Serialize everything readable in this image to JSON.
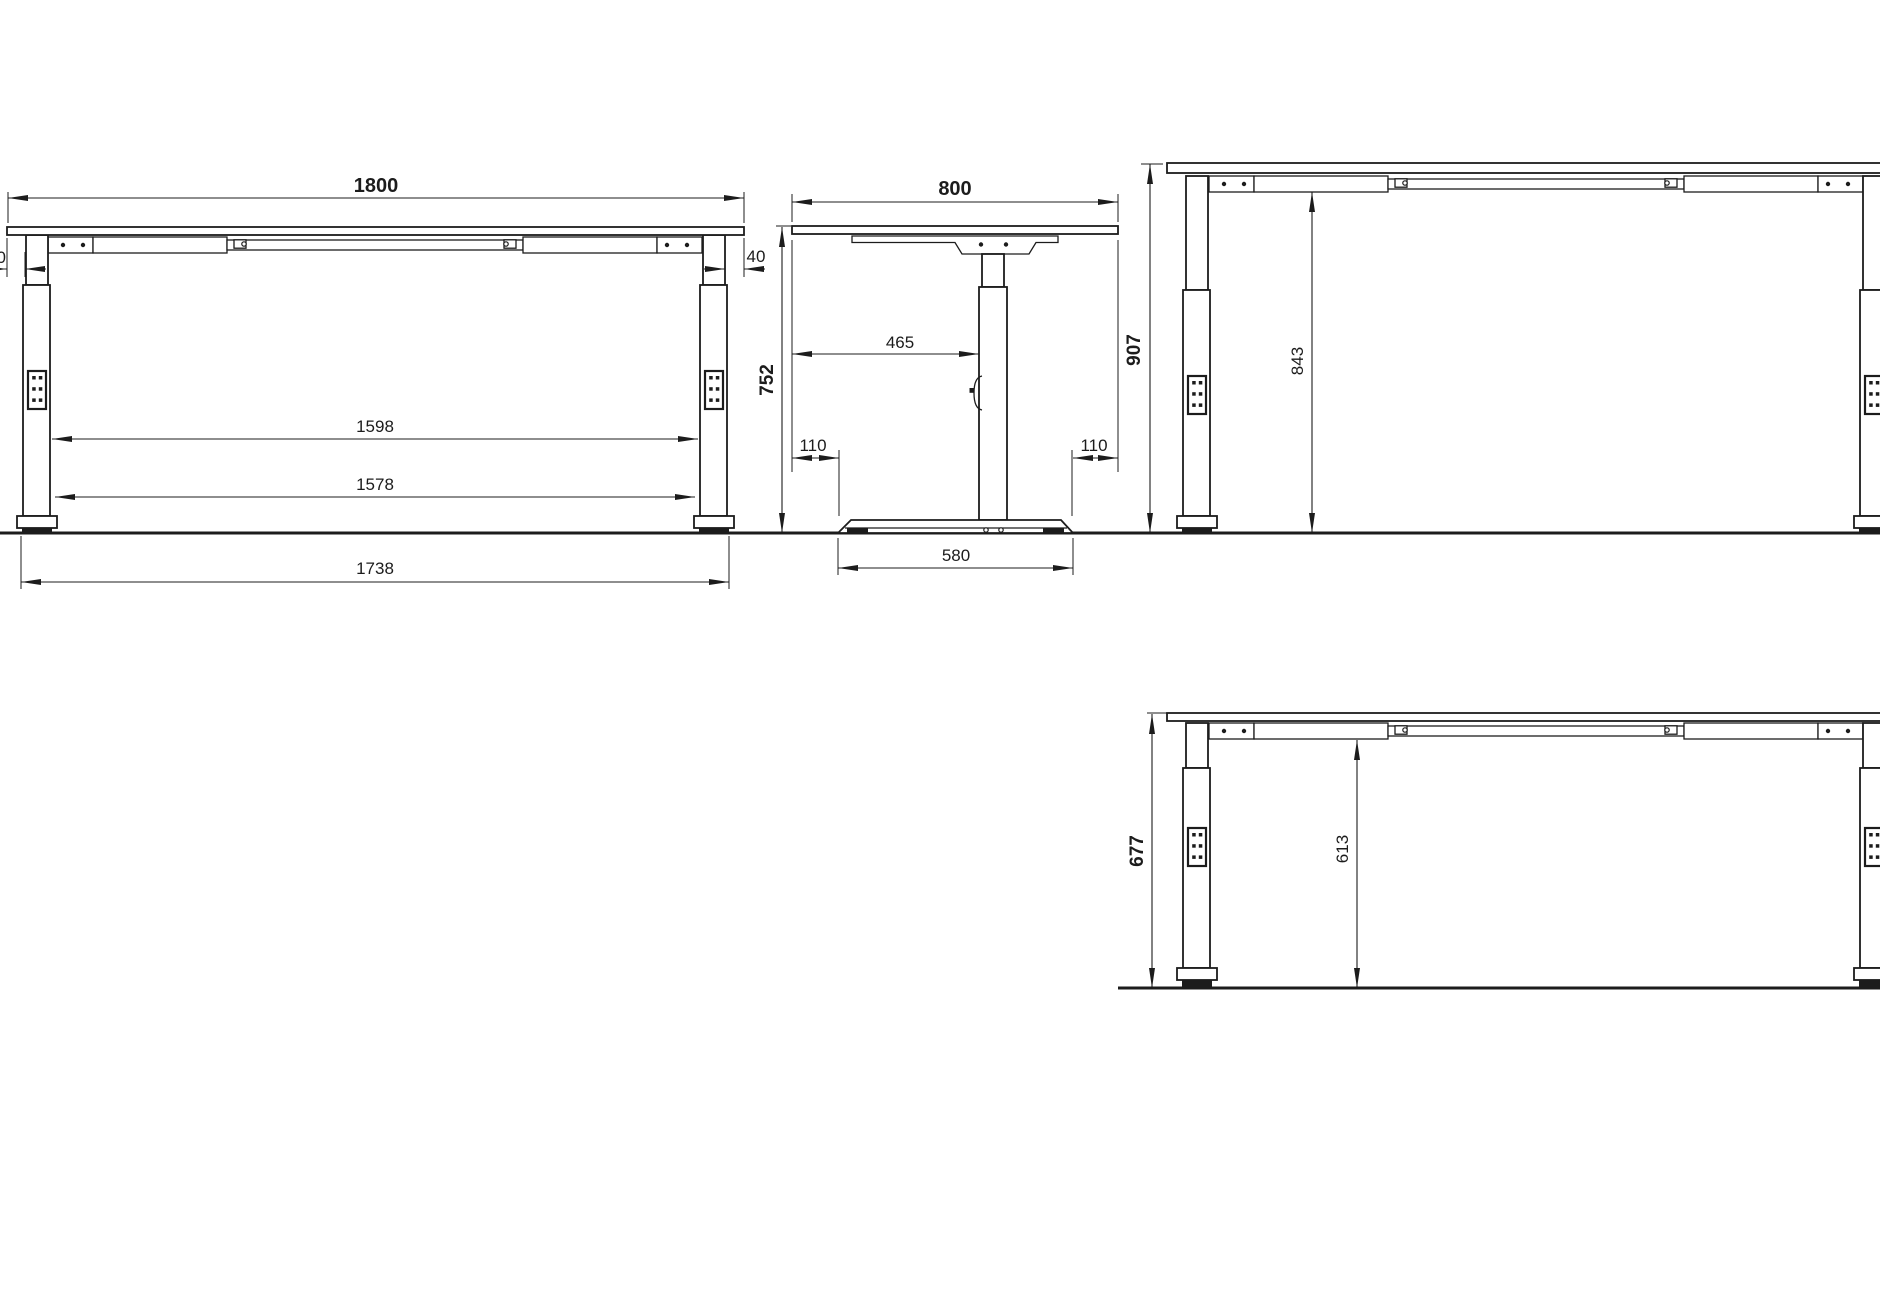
{
  "drawing_colors": {
    "line": "#1c1c1c",
    "background": "#ffffff"
  },
  "views": {
    "front": {
      "label": "front-view",
      "dims": {
        "top_width": "1800",
        "overhang_left": "40",
        "overhang_right": "40",
        "clear_width_upper": "1598",
        "clear_width_lower": "1578",
        "foot_outer_span": "1738"
      }
    },
    "side": {
      "label": "side-view",
      "dims": {
        "top_depth": "800",
        "desk_height": "752",
        "top_to_column": "465",
        "front_overhang": "110",
        "rear_overhang": "110",
        "foot_length": "580"
      }
    },
    "raised": {
      "label": "raised-height-view",
      "dims": {
        "desk_height": "907",
        "underframe_clearance": "843"
      }
    },
    "lowered": {
      "label": "lowered-height-view",
      "dims": {
        "desk_height": "677",
        "underframe_clearance": "613"
      }
    }
  }
}
